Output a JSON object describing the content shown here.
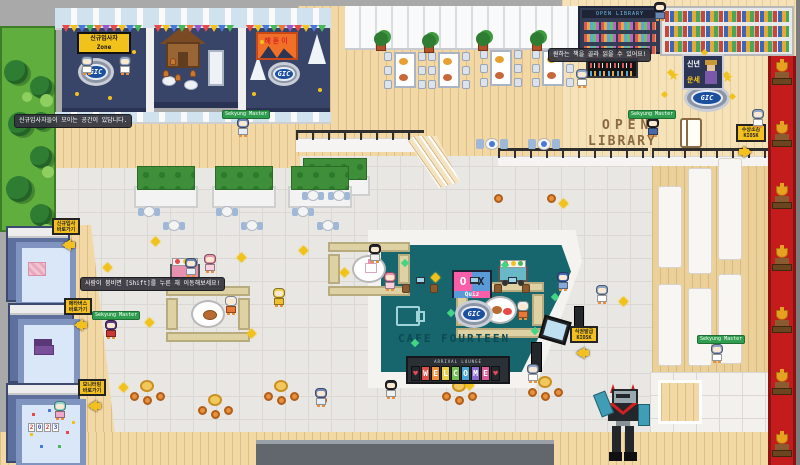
{
  "logo": {
    "text": "GIC"
  },
  "booths": {
    "newbie_sign": {
      "line1": "신규입사자",
      "line2": "Zone"
    },
    "sunrise_banner": {
      "text": "해돋이"
    },
    "fortune_sign": {
      "line1": "신년",
      "line2": "운세"
    }
  },
  "library": {
    "shelf_header": "OPEN LIBRARY",
    "floor_text": {
      "word1": "OPEN",
      "word2": "LIBRARY"
    },
    "kiosk_sign": {
      "line1": "수상소감",
      "line2": "KIOSK"
    }
  },
  "cafe": {
    "ox_sign": {
      "o": "O",
      "x": "X",
      "quiz": "Quiz"
    },
    "floor_text": "CAFE FOURTEEN",
    "welcome_board": {
      "header": "ARRIVAL LOUNGE",
      "letters": [
        "♥",
        "W",
        "E",
        "L",
        "C",
        "O",
        "M",
        "E",
        "♥"
      ],
      "tile_colors": [
        "#23262b",
        "#e05048",
        "#ef9038",
        "#e8cf4a",
        "#74c055",
        "#4aa4d4",
        "#8a6ace",
        "#d85a9a",
        "#23262b"
      ],
      "heart_color": "#e84858"
    },
    "kiosk_sign": {
      "line1": "식권발급",
      "line2": "KIOSK"
    }
  },
  "left_signs": [
    {
      "line1": "신규입사",
      "line2": "바로가기"
    },
    {
      "line1": "메타버스",
      "line2": "바로가기"
    },
    {
      "line1": "모니터링",
      "line2": "바로가기"
    }
  ],
  "party_room": {
    "year": "2023"
  },
  "tooltips": {
    "newbie": "신규입사자들이 모이는 공간이 있답니다.",
    "crowd": "사람이 붐비면 [Shift]를 누른 채 이동해보세요!",
    "library": "원하는 책을 골라 읽을 수 있어요!"
  },
  "players": {
    "nametag": "Sekyung Master"
  },
  "colors": {
    "cafe_floor": "#17666e",
    "booth_floor": "#394469",
    "carpet_red": "#c41c1c",
    "sign_yellow": "#f4c020",
    "logo_blue": "#1b4fa0",
    "nametag_green": "#2f9e4f"
  },
  "sprites": {
    "bunting_colors": [
      "#e84848",
      "#f2c21c",
      "#4878d8",
      "#48b858",
      "#e87838",
      "#9858c8"
    ],
    "bunting_rows": [
      {
        "x": 62,
        "y": 25,
        "w": 84
      },
      {
        "x": 154,
        "y": 25,
        "w": 84
      },
      {
        "x": 246,
        "y": 25,
        "w": 84
      }
    ],
    "dining_sets": [
      {
        "x": 384,
        "y": 52
      },
      {
        "x": 428,
        "y": 52
      },
      {
        "x": 480,
        "y": 50
      },
      {
        "x": 532,
        "y": 50
      }
    ],
    "plants": [
      [
        376,
        32
      ],
      [
        424,
        34
      ],
      [
        478,
        32
      ],
      [
        532,
        32
      ]
    ],
    "cafe_tables_top": [
      [
        476,
        136
      ],
      [
        528,
        136
      ]
    ],
    "blue_tables": [
      [
        138,
        206
      ],
      [
        163,
        220
      ],
      [
        216,
        206
      ],
      [
        241,
        220
      ],
      [
        292,
        206
      ],
      [
        317,
        220
      ],
      [
        302,
        190
      ],
      [
        328,
        190
      ]
    ],
    "picnic_tables": [
      {
        "x": 328,
        "y": 242,
        "w": 82,
        "h": 54,
        "food": "cake"
      },
      {
        "x": 166,
        "y": 286,
        "w": 84,
        "h": 56,
        "food": "roast"
      },
      {
        "x": 456,
        "y": 282,
        "w": 88,
        "h": 56,
        "food": "mixed"
      }
    ],
    "carts": [
      {
        "x": 170,
        "y": 258,
        "c": "#e890b0"
      },
      {
        "x": 498,
        "y": 260,
        "c": "#68b8c8"
      }
    ],
    "stool_clusters": [
      [
        130,
        380
      ],
      [
        198,
        394
      ],
      [
        264,
        380
      ],
      [
        442,
        380
      ],
      [
        528,
        376
      ]
    ],
    "lone_stools": [
      [
        494,
        194
      ],
      [
        547,
        194
      ],
      [
        318,
        396
      ],
      [
        600,
        398
      ]
    ],
    "counter_items": [
      [
        402,
        284
      ],
      [
        430,
        284
      ],
      [
        494,
        284
      ],
      [
        522,
        284
      ]
    ],
    "laptops": [
      [
        416,
        277
      ],
      [
        470,
        277
      ],
      [
        508,
        277
      ]
    ],
    "trophies_x": 772,
    "trophies_y": [
      62,
      124,
      186,
      248,
      310,
      372,
      434
    ],
    "gold_stars": [
      [
        152,
        238
      ],
      [
        104,
        264
      ],
      [
        238,
        254
      ],
      [
        300,
        247
      ],
      [
        341,
        269
      ],
      [
        432,
        274
      ],
      [
        146,
        319
      ],
      [
        248,
        330
      ],
      [
        120,
        384
      ],
      [
        466,
        382
      ],
      [
        560,
        200
      ],
      [
        620,
        298
      ]
    ],
    "library_sparkles": [
      [
        668,
        70
      ],
      [
        724,
        72
      ],
      [
        702,
        50
      ],
      [
        662,
        92
      ],
      [
        730,
        94
      ]
    ],
    "green_sparkles": [
      [
        402,
        260
      ],
      [
        448,
        310
      ],
      [
        502,
        262
      ],
      [
        532,
        328
      ],
      [
        412,
        340
      ],
      [
        552,
        294
      ]
    ],
    "booth_dots": [
      [
        75,
        92
      ],
      [
        132,
        50
      ],
      [
        108,
        96
      ],
      [
        252,
        92
      ],
      [
        318,
        88
      ],
      [
        260,
        40
      ]
    ],
    "ginger_men": [
      [
        163,
        70
      ],
      [
        175,
        74
      ],
      [
        190,
        70
      ],
      [
        170,
        58
      ]
    ],
    "bleacher_panels": [
      [
        658,
        186,
        24,
        82
      ],
      [
        688,
        168,
        24,
        106
      ],
      [
        718,
        158,
        24,
        102
      ],
      [
        658,
        284,
        24,
        82
      ],
      [
        688,
        288,
        24,
        78
      ],
      [
        718,
        274,
        24,
        90
      ]
    ],
    "garden_trees": [
      [
        2,
        32,
        24
      ],
      [
        28,
        48,
        22
      ],
      [
        6,
        84,
        24
      ],
      [
        28,
        118,
        22
      ],
      [
        4,
        148,
        26
      ],
      [
        28,
        176,
        22
      ],
      [
        8,
        202,
        24
      ],
      [
        30,
        84,
        18
      ]
    ],
    "garden_bushes": [
      [
        38,
        66,
        13
      ],
      [
        40,
        138,
        12
      ],
      [
        38,
        196,
        13
      ],
      [
        20,
        64,
        10
      ]
    ],
    "confetti": [
      [
        10,
        8
      ],
      [
        26,
        4
      ],
      [
        40,
        10
      ],
      [
        8,
        28
      ],
      [
        44,
        26
      ],
      [
        18,
        40
      ],
      [
        36,
        40
      ],
      [
        50,
        16
      ]
    ],
    "confetti_colors": [
      "#e84848",
      "#4878d8",
      "#48b858",
      "#f2c21c"
    ],
    "avatars": [
      {
        "x": 80,
        "y": 56,
        "h": "#8fa6c8",
        "b": "#ffffff"
      },
      {
        "x": 118,
        "y": 56,
        "h": "#8fa6c8",
        "b": "#ffffff"
      },
      {
        "x": 236,
        "y": 118,
        "h": "#6f87b8",
        "b": "#e8eef8"
      },
      {
        "x": 104,
        "y": 320,
        "h": "#5a3a7a",
        "b": "#c83838"
      },
      {
        "x": 646,
        "y": 118,
        "h": "#26262e",
        "b": "#4868a8"
      },
      {
        "x": 710,
        "y": 344,
        "h": "#8fa6c8",
        "b": "#ffffff"
      },
      {
        "x": 751,
        "y": 109,
        "h": "#8fa6c8",
        "b": "#ffffff"
      },
      {
        "x": 575,
        "y": 69,
        "h": "#8fa6c8",
        "b": "#ffffff"
      },
      {
        "x": 368,
        "y": 244,
        "h": "#26262e",
        "b": "#f0f0f0"
      },
      {
        "x": 224,
        "y": 296,
        "h": "#f0f0f0",
        "b": "#e87838"
      },
      {
        "x": 516,
        "y": 301,
        "h": "#f0f0f0",
        "b": "#e87838"
      },
      {
        "x": 272,
        "y": 288,
        "h": "#f0d048",
        "b": "#f0c030"
      },
      {
        "x": 184,
        "y": 258,
        "h": "#6f87b8",
        "b": "#e8eef8"
      },
      {
        "x": 203,
        "y": 254,
        "h": "#e890b0",
        "b": "#f8d0e0"
      },
      {
        "x": 383,
        "y": 272,
        "h": "#e890b0",
        "b": "#f8d0e0"
      },
      {
        "x": 556,
        "y": 272,
        "h": "#4868b8",
        "b": "#88a8d8"
      },
      {
        "x": 595,
        "y": 285,
        "h": "#8fa6c8",
        "b": "#ffffff"
      },
      {
        "x": 526,
        "y": 364,
        "h": "#8fa6c8",
        "b": "#ffffff"
      },
      {
        "x": 314,
        "y": 388,
        "h": "#6f87b8",
        "b": "#e8eef8"
      },
      {
        "x": 384,
        "y": 380,
        "h": "#26262e",
        "b": "#f0f0f0"
      },
      {
        "x": 53,
        "y": 401,
        "h": "#88d8d0",
        "b": "#f0a8c8"
      },
      {
        "x": 653,
        "y": 2,
        "h": "#26262e",
        "b": "#6888b8"
      }
    ],
    "nametags": [
      [
        92,
        311
      ],
      [
        222,
        110
      ],
      [
        628,
        110
      ],
      [
        697,
        335
      ]
    ]
  }
}
